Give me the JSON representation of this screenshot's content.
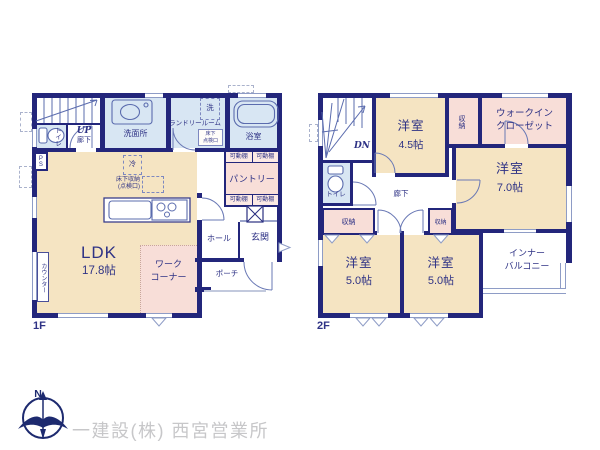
{
  "floor1": {
    "label": "1F",
    "stairs_up": "UP",
    "corridor": "廊下",
    "toilet": "トイレ",
    "pipe_space": "PS",
    "washroom": "洗面所",
    "laundry_room": "ランドリールーム",
    "washer": "洗",
    "hatch_line1": "床下",
    "hatch_line2": "点検口",
    "bathroom": "浴室",
    "movable_shelf": "可動棚",
    "pantry": "パントリー",
    "fridge": "冷",
    "underfloor_line1": "床下収納",
    "underfloor_line2": "(点検口)",
    "ldk": {
      "name": "LDK",
      "size": "17.8帖"
    },
    "work_line1": "ワーク",
    "work_line2": "コーナー",
    "counter": "カウンター",
    "hall": "ホール",
    "entrance": "玄関",
    "porch": "ポーチ"
  },
  "floor2": {
    "label": "2F",
    "stairs_down": "DN",
    "room_45": {
      "name": "洋室",
      "size": "4.5帖"
    },
    "room_70": {
      "name": "洋室",
      "size": "7.0帖"
    },
    "room_50a": {
      "name": "洋室",
      "size": "5.0帖"
    },
    "room_50b": {
      "name": "洋室",
      "size": "5.0帖"
    },
    "closet": "収納",
    "wic_line1": "ウォークイン",
    "wic_line2": "クローゼット",
    "toilet": "トイレ",
    "corridor": "廊下",
    "balcony_line1": "インナー",
    "balcony_line2": "バルコニー"
  },
  "footer": {
    "north": "N",
    "company": "一建設(株) 西宮営業所"
  },
  "colors": {
    "wall": "#23267b",
    "room_cream": "#f5e4c2",
    "room_blue": "#d8e6f3",
    "room_pink": "#f8ded8",
    "fixture_line": "#5b6cae",
    "text": "#2e3285",
    "logo_text": "#c7c7c9"
  }
}
